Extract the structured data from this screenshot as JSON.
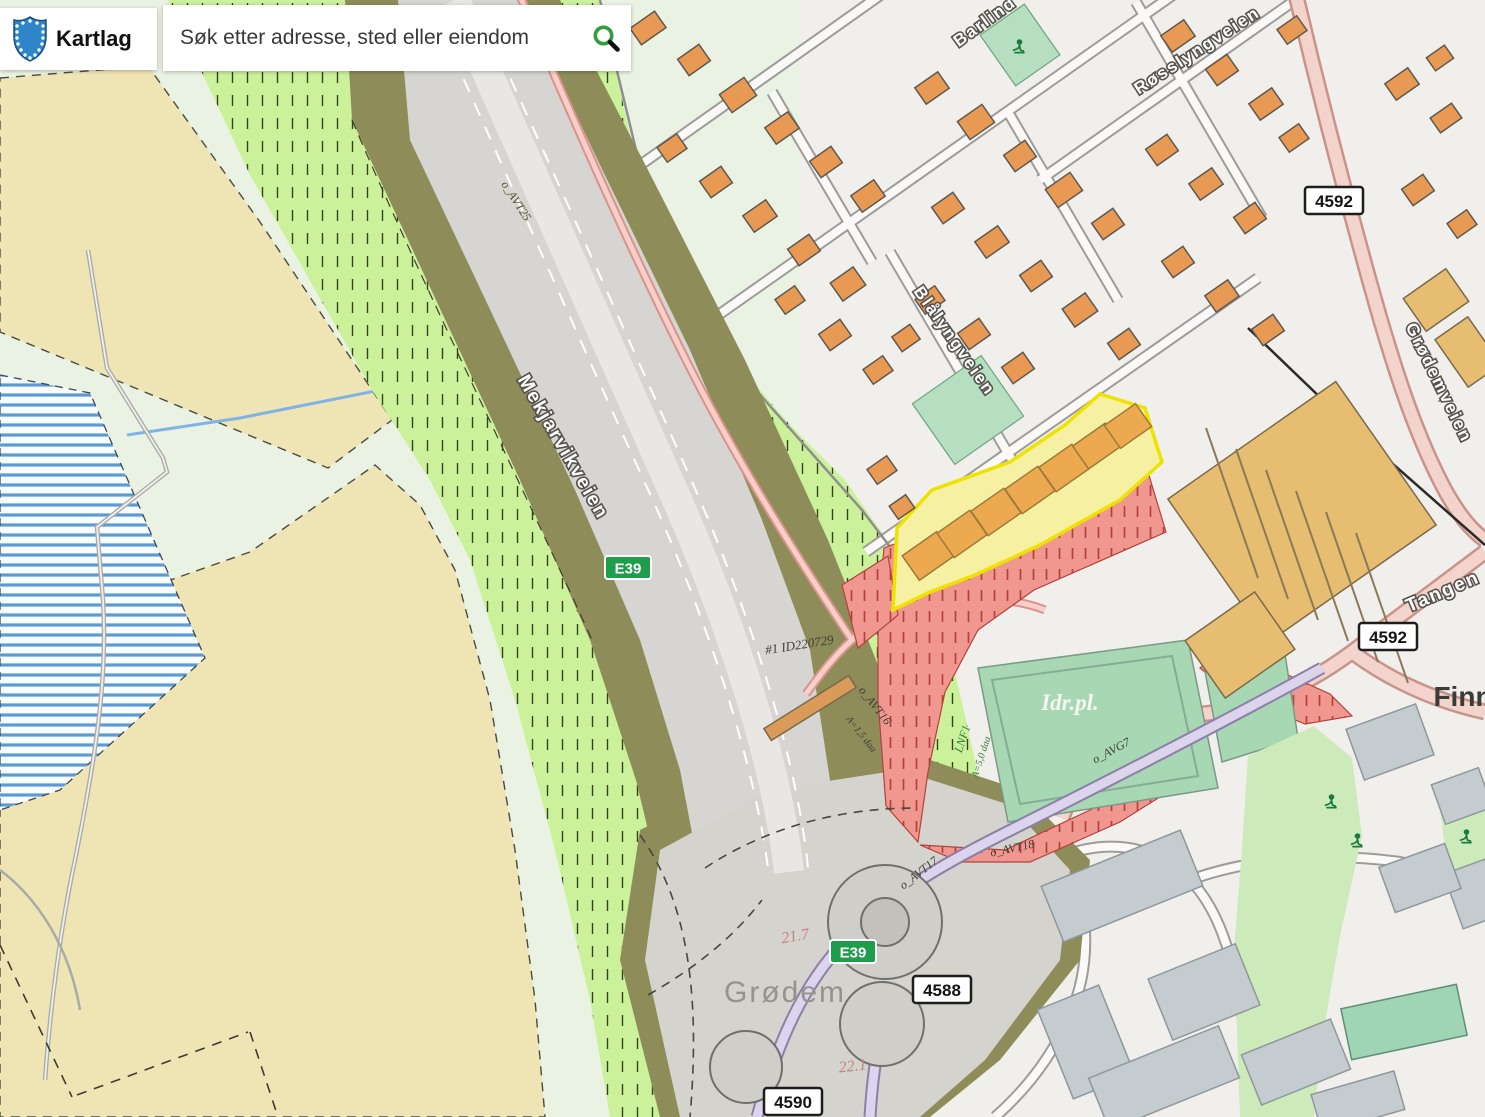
{
  "app": {
    "brand": "Kartlag",
    "search": {
      "placeholder": "Søk etter adresse, sted eller eiendom"
    }
  },
  "map": {
    "route_signs": [
      {
        "text": "E39",
        "type": "european",
        "x": 628,
        "y": 568
      },
      {
        "text": "E39",
        "type": "european",
        "x": 853,
        "y": 952
      },
      {
        "text": "4592",
        "type": "county",
        "x": 1334,
        "y": 201
      },
      {
        "text": "4592",
        "type": "county",
        "x": 1388,
        "y": 637
      },
      {
        "text": "4588",
        "type": "county",
        "x": 942,
        "y": 990
      },
      {
        "text": "4590",
        "type": "county",
        "x": 793,
        "y": 1102
      }
    ],
    "street_labels": [
      {
        "text": "Mekjarvikveien",
        "x": 558,
        "y": 450,
        "rotate": 60,
        "size": 19
      },
      {
        "text": "Blålyngveien",
        "x": 950,
        "y": 344,
        "rotate": 55,
        "size": 17
      },
      {
        "text": "Røsslyngveien",
        "x": 1200,
        "y": 55,
        "rotate": -33,
        "size": 17
      },
      {
        "text": "Barlind",
        "x": 988,
        "y": 26,
        "rotate": -36,
        "size": 17
      },
      {
        "text": "Grødemveien",
        "x": 1434,
        "y": 385,
        "rotate": 64,
        "size": 17
      },
      {
        "text": "Tangen",
        "x": 1445,
        "y": 597,
        "rotate": -23,
        "size": 19
      }
    ],
    "place_labels": [
      {
        "text": "Grødem",
        "x": 785,
        "y": 1002,
        "style": "muted",
        "size": 30
      },
      {
        "text": "Finn",
        "x": 1463,
        "y": 706,
        "style": "dark",
        "size": 28
      },
      {
        "text": "Idr.pl.",
        "x": 1070,
        "y": 710,
        "style": "field",
        "size": 23
      }
    ],
    "zone_labels": [
      {
        "text": "o_AVT25",
        "x": 513,
        "y": 203,
        "rotate": 57,
        "color": "olive",
        "size": 12
      },
      {
        "text": "#1 ID220729",
        "x": 800,
        "y": 649,
        "rotate": -9,
        "color": "dark",
        "size": 13
      },
      {
        "text": "o_AVT16",
        "x": 872,
        "y": 708,
        "rotate": 52,
        "color": "dark",
        "size": 12
      },
      {
        "text": "A=1,5 daa",
        "x": 859,
        "y": 736,
        "rotate": 52,
        "color": "dark",
        "size": 10
      },
      {
        "text": "o_AVT18",
        "x": 1013,
        "y": 852,
        "rotate": -12,
        "color": "dark",
        "size": 12
      },
      {
        "text": "o_AVT17",
        "x": 921,
        "y": 876,
        "rotate": -38,
        "color": "dark",
        "size": 12
      },
      {
        "text": "o_AVG7",
        "x": 1113,
        "y": 754,
        "rotate": -28,
        "color": "dark",
        "size": 12
      },
      {
        "text": "LNF1",
        "x": 966,
        "y": 740,
        "rotate": -72,
        "color": "green",
        "size": 12
      },
      {
        "text": "A=5,0 daa",
        "x": 984,
        "y": 758,
        "rotate": -72,
        "color": "green",
        "size": 10
      },
      {
        "text": "21.7",
        "x": 796,
        "y": 941,
        "rotate": -10,
        "color": "red",
        "size": 16
      },
      {
        "text": "22.1",
        "x": 853,
        "y": 1071,
        "rotate": -6,
        "color": "red",
        "size": 16
      }
    ],
    "playground_icons": [
      {
        "x": 1018,
        "y": 48
      },
      {
        "x": 1330,
        "y": 803
      },
      {
        "x": 1356,
        "y": 842
      },
      {
        "x": 1465,
        "y": 838
      }
    ],
    "colors": {
      "zone_green_hatch": "#CBF29B",
      "zone_red_hatch": "#F0988F",
      "zone_yellow": "#F6F0A2",
      "zone_yellow_border": "#EDE200",
      "olive_buffer": "#8E8C58",
      "field_beige": "#EFE4B4",
      "meadow_mint": "#EAF3E3",
      "water_stripe": "#5B9BD5",
      "sports_field": "#A7D7B3",
      "park_green": "#CDEABB",
      "house_orange": "#E89A55",
      "industrial_tan": "#E7BD72",
      "building_gray": "#C4CCCF",
      "road_pink": "#F3D4CC",
      "road_lavender": "#DCD3EC",
      "motorway_gray": "#D6D5D1",
      "sign_green": "#1E9E4C"
    }
  }
}
